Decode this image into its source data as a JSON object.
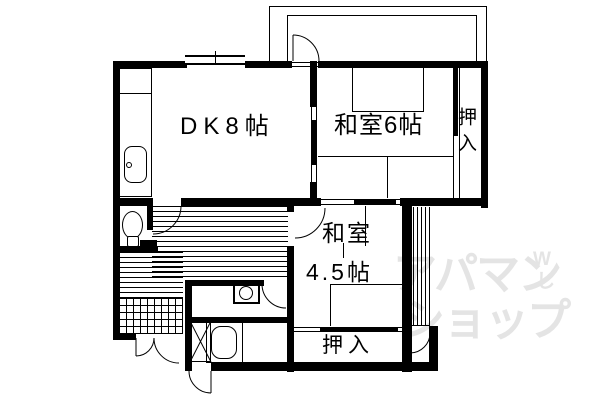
{
  "rooms": {
    "dk": {
      "label": "DK8帖"
    },
    "japanese_room_6": {
      "label": "和室6帖"
    },
    "japanese_room_45": {
      "name": "和室",
      "size": "4.5帖"
    },
    "closet_upper": {
      "label": "押入"
    },
    "closet_lower": {
      "label": "押入"
    }
  },
  "watermark": {
    "line1": "アパマン",
    "line2": "ショップ",
    "mark_top": "W",
    "mark_bottom": "し",
    "color": "#e4e4e4"
  },
  "colors": {
    "line": "#000000",
    "background": "#ffffff"
  }
}
